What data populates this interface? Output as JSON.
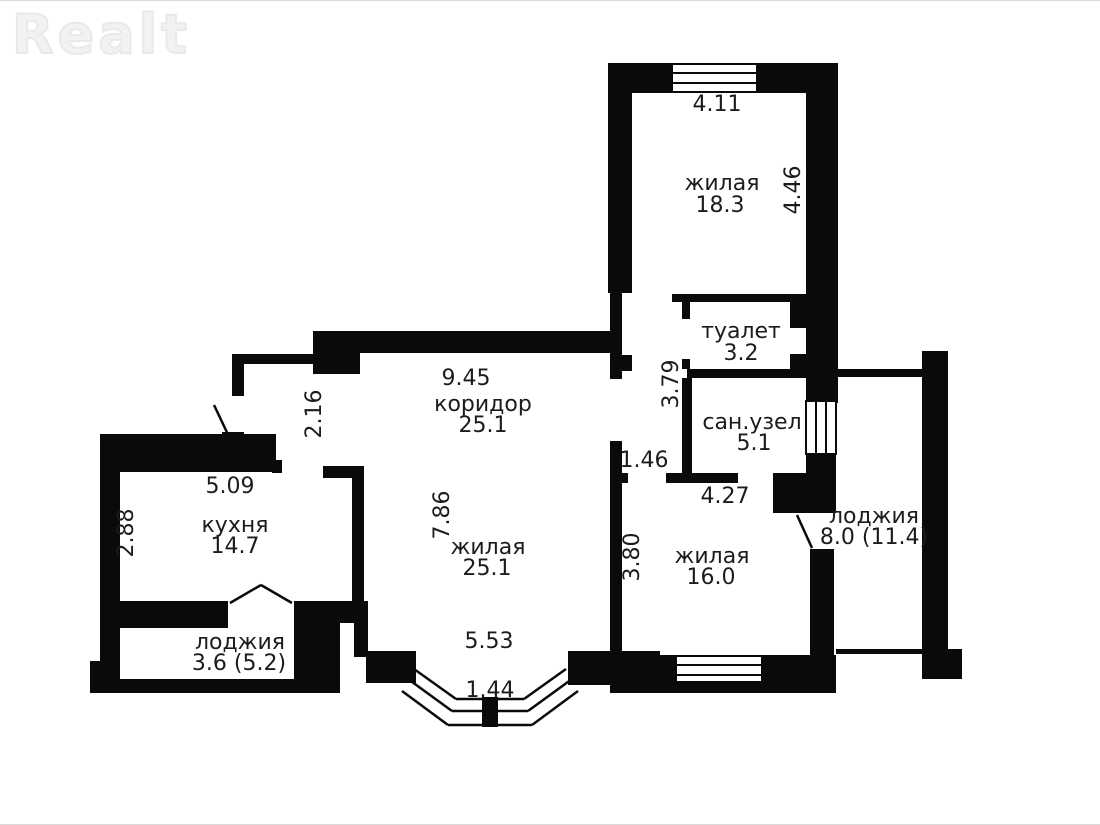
{
  "logo": {
    "text": "Realt"
  },
  "floorplan": {
    "rooms": [
      {
        "id": "living-top",
        "name": "жилая",
        "area": "18.3"
      },
      {
        "id": "toilet",
        "name": "туалет",
        "area": "3.2"
      },
      {
        "id": "bathroom",
        "name": "сан.узел",
        "area": "5.1"
      },
      {
        "id": "corridor",
        "name": "коридор",
        "area": "25.1"
      },
      {
        "id": "living-center",
        "name": "жилая",
        "area": "25.1"
      },
      {
        "id": "kitchen",
        "name": "кухня",
        "area": "14.7"
      },
      {
        "id": "living-right",
        "name": "жилая",
        "area": "16.0"
      },
      {
        "id": "loggia-left",
        "name": "лоджия",
        "area": "3.6 (5.2)"
      },
      {
        "id": "loggia-right",
        "name": "лоджия",
        "area": "8.0 (11.4)"
      }
    ],
    "dimensions": {
      "top_room_width": "4.11",
      "top_room_height": "4.46",
      "corridor_width": "9.45",
      "corridor_step_height": "2.16",
      "wc_nook_height": "3.79",
      "kitchen_width": "5.09",
      "kitchen_height": "2.88",
      "room16_opening_width": "1.46",
      "room16_width": "4.27",
      "living_center_height": "7.86",
      "room16_height": "3.80",
      "living_center_width": "5.53",
      "bay_window_width": "1.44"
    },
    "colors": {
      "wall": "#0a0a0a",
      "label_text": "#1c1c1c",
      "logo": "#f2f2f2",
      "background": "#ffffff"
    }
  }
}
